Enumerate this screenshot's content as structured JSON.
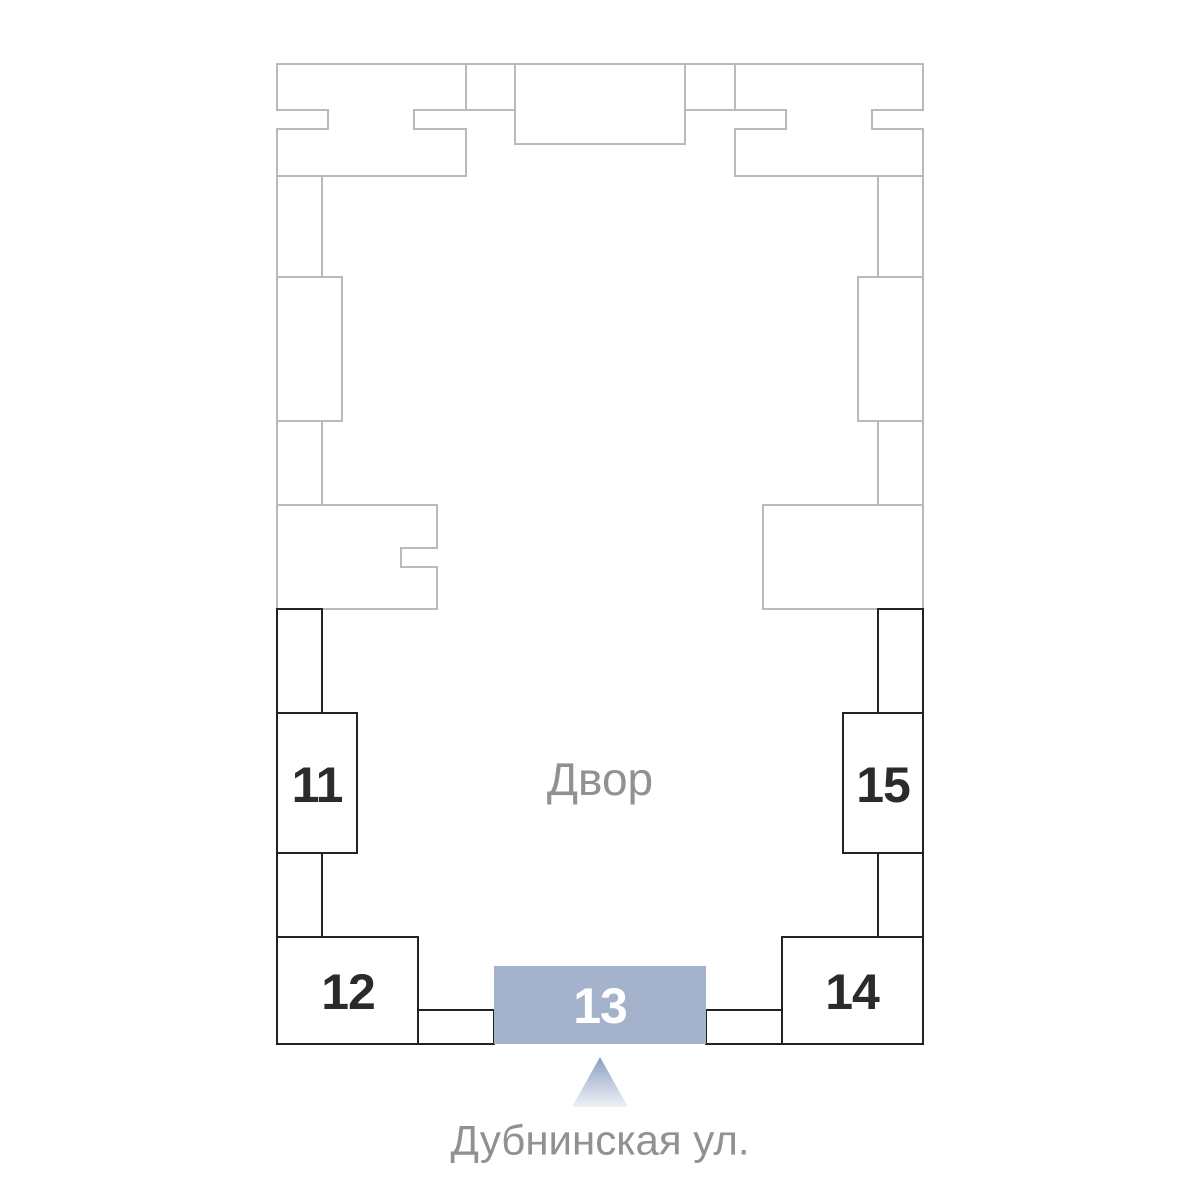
{
  "plan": {
    "courtyard_label": "Двор",
    "street_label": "Дубнинская ул.",
    "buildings": [
      {
        "number": "11",
        "selected": false
      },
      {
        "number": "12",
        "selected": false
      },
      {
        "number": "13",
        "selected": true
      },
      {
        "number": "14",
        "selected": false
      },
      {
        "number": "15",
        "selected": false
      }
    ],
    "colors": {
      "highlight_fill": "#a4b2cb",
      "highlight_number": "#ffffff",
      "number": "#2b2b2e",
      "outline_dark": "#232327",
      "outline_light": "#bababa",
      "label_gray": "#919194",
      "arrow_gradient_top": "#8c9fc0",
      "arrow_gradient_bottom": "#eef1f6"
    }
  }
}
